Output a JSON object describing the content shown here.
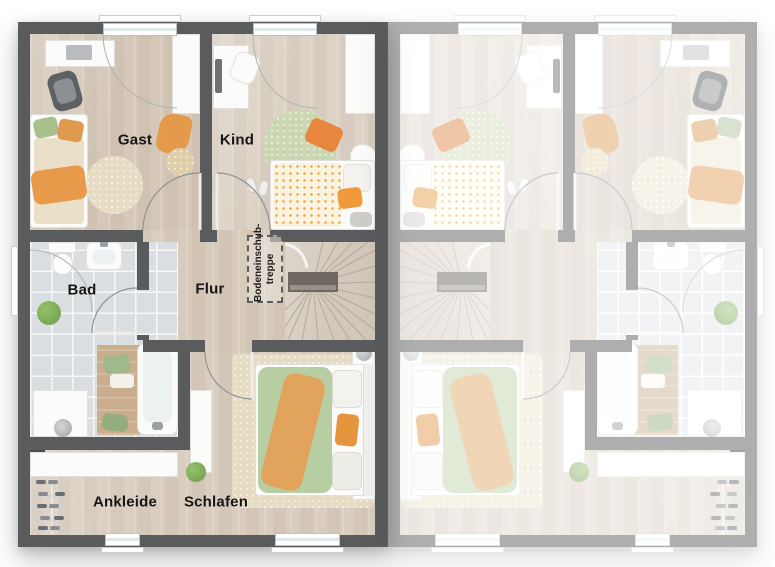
{
  "rooms": {
    "gast": "Gast",
    "kind": "Kind",
    "bad": "Bad",
    "flur": "Flur",
    "ankleide": "Ankleide",
    "schlafen": "Schlafen"
  },
  "attic_stairs_label": {
    "line1": "Bodeneinschub-",
    "line2": "treppe"
  },
  "colors": {
    "wall": "#5a5b5d",
    "wood": "#d7cbbc",
    "tile": "#dbdee0",
    "stair_wood": "#d2c7ba",
    "accent_orange": "#e6953f",
    "accent_green": "#b7cda2",
    "rug_beige": "#e6dcc3",
    "rug_green": "#cbd7b2"
  }
}
